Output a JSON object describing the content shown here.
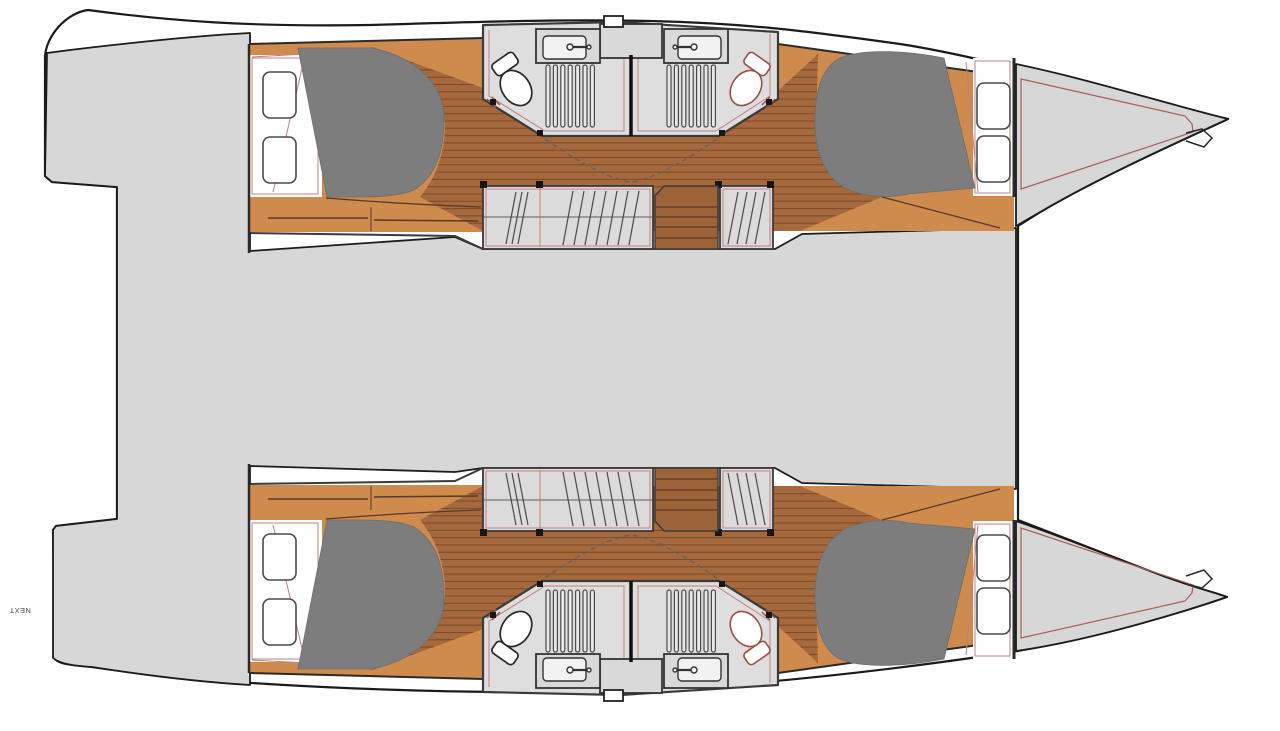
{
  "meta": {
    "title": "Catamaran interior floor plan (top view, 4-cabin / 2-head layout)",
    "canvas": {
      "width": 1280,
      "height": 731
    }
  },
  "labels": {
    "next": "NEXT"
  },
  "palette": {
    "outline": "#1b1b1b",
    "deck": "#d7d7d7",
    "bathroom": "#dedede",
    "wall": "#3a3a3a",
    "joinery": "#cf8a4e",
    "floor": "#a5693d",
    "plank": "#7c4a29",
    "stairs": "#9c6238",
    "stairLine": "#6b4023",
    "bed": "#7d7d7d",
    "cabinet": "#dbdbdb",
    "trimPink": "#c08080",
    "toiletRed": "#9b4f48",
    "hatchStroke": "#4a4a4a"
  },
  "legend": {
    "orientation": "bows to the right, sterns to the left",
    "hulls": [
      {
        "id": "top-hull",
        "rooms": [
          {
            "name": "aft cabin",
            "features": [
              "double berth",
              "2 deck hatches",
              "storage drawers"
            ]
          },
          {
            "name": "head / shower",
            "features": [
              "sink",
              "toilet",
              "shower grating",
              "door"
            ]
          },
          {
            "name": "second head / shower",
            "features": [
              "sink",
              "toilet (red)",
              "shower grating",
              "door"
            ]
          },
          {
            "name": "companionway stairs",
            "features": [
              "4 steps"
            ]
          },
          {
            "name": "hanging lockers",
            "features": [
              "wardrobe hatching"
            ]
          },
          {
            "name": "forward cabin",
            "features": [
              "double berth",
              "2 deck hatches"
            ]
          },
          {
            "name": "bow locker",
            "features": [
              "trampoline / anchor fitting"
            ]
          }
        ]
      },
      {
        "id": "bottom-hull",
        "rooms": [
          {
            "name": "mirror image of top hull",
            "features": [
              "aft cabin",
              "2 heads",
              "stairs",
              "lockers",
              "forward cabin",
              "bow locker"
            ]
          }
        ]
      }
    ],
    "center": "bridge deck / saloon area (undetailed grey)"
  }
}
